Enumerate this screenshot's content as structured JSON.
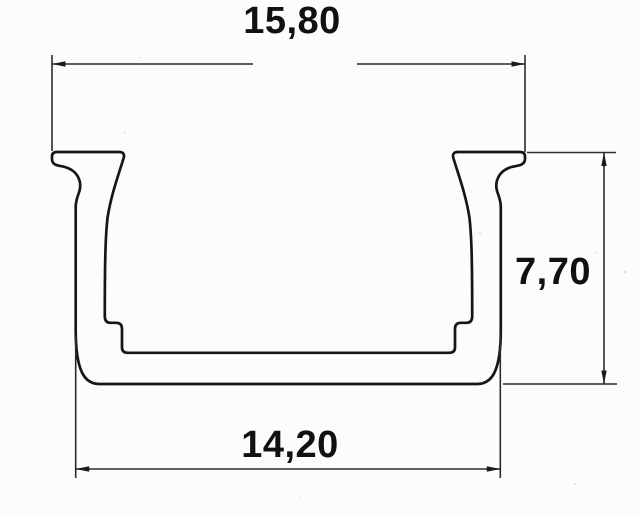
{
  "drawing": {
    "dimensions": {
      "top_width": "15,80",
      "side_height": "7,70",
      "bottom_width": "14,20"
    },
    "style": {
      "line_color": "#161616",
      "dimension_line_color": "#2b2b2b",
      "label_color": "#111111",
      "background": "#fcfcfc"
    }
  }
}
